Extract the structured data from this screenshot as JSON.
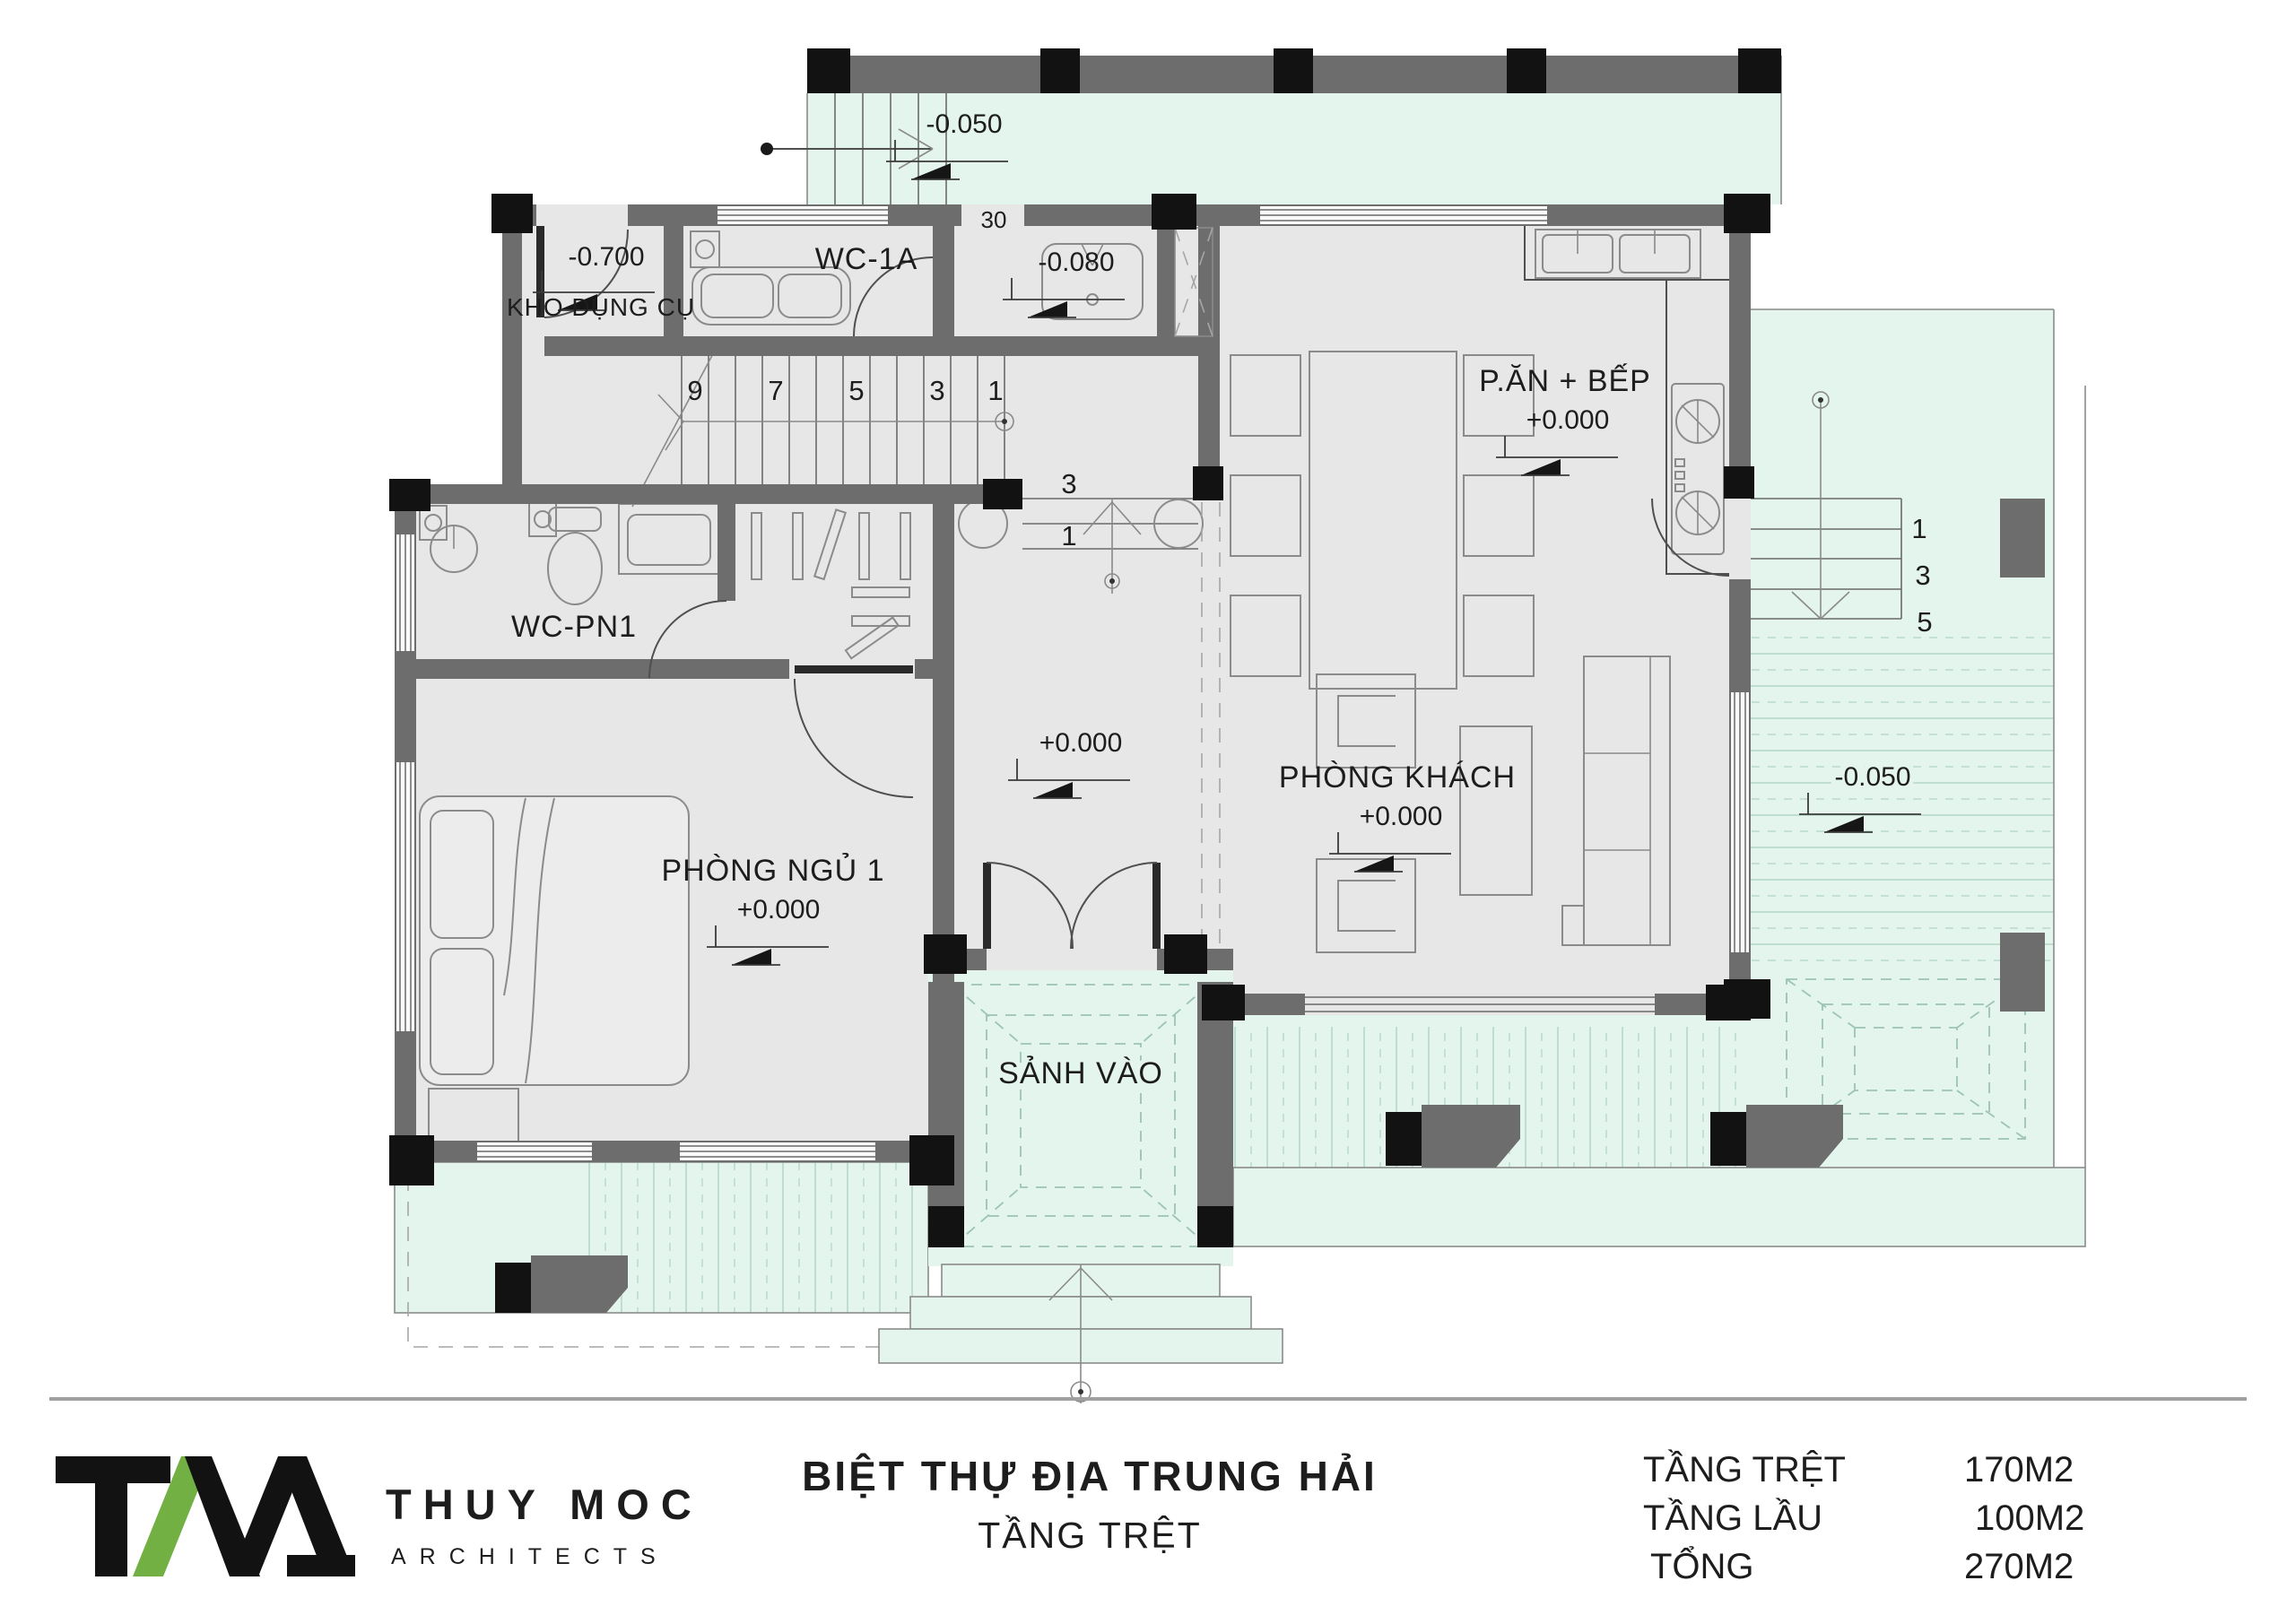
{
  "plan": {
    "rooms": {
      "kho": {
        "name": "KHO DỤNG CỤ",
        "level": "-0.700"
      },
      "wc1a": {
        "name": "WC-1A"
      },
      "small_wc": {
        "level": "-0.080"
      },
      "kitchen": {
        "name": "P.ĂN + BẾP",
        "level": "+0.000"
      },
      "wcpn1": {
        "name": "WC-PN1"
      },
      "hall": {
        "level": "+0.000"
      },
      "living": {
        "name": "PHÒNG KHÁCH",
        "level": "+0.000"
      },
      "bedroom": {
        "name": "PHÒNG NGỦ 1",
        "level": "+0.000"
      },
      "entry": {
        "name": "SẢNH VÀO"
      },
      "terrace_top": {
        "level": "-0.050"
      },
      "terrace_right": {
        "level": "-0.050"
      }
    },
    "stair_main": {
      "n1": "9",
      "n2": "7",
      "n3": "5",
      "n4": "3",
      "n5": "1"
    },
    "steps_hall": {
      "top": "3",
      "bottom": "1"
    },
    "steps_right": {
      "top": "1",
      "mid": "3",
      "bottom": "5"
    },
    "dims": {
      "w30": "30"
    }
  },
  "footer": {
    "title": "BIỆT THỰ ĐỊA TRUNG HẢI",
    "subtitle": "TẦNG TRỆT",
    "logo": {
      "brand": "THUY MOC",
      "tagline": "ARCHITECTS"
    },
    "areas": {
      "row1": {
        "label": "TẦNG TRỆT",
        "value": "170M2"
      },
      "row2": {
        "label": "TẦNG LẦU",
        "value": "100M2"
      },
      "row3": {
        "label": "TỔNG",
        "value": "270M2"
      }
    }
  },
  "colors": {
    "accent_green": "#72b043",
    "terrace_mint": "#e4f5ed",
    "wall_gray": "#6d6d6d",
    "floor_gray": "#e7e7e7"
  }
}
